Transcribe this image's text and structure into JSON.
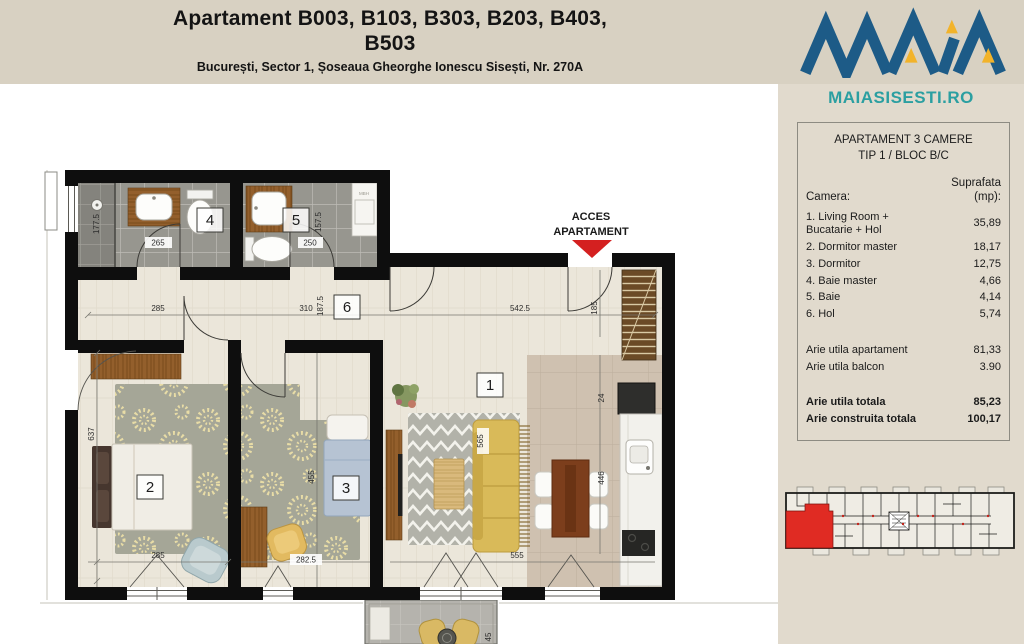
{
  "header": {
    "title_line1": "Apartament B003, B103, B303, B203, B403,",
    "title_line2": "B503",
    "subtitle": "București, Sector 1, Șoseaua Gheorghe Ionescu Sisești, Nr. 270A"
  },
  "logo": {
    "brand": "MAIA",
    "site": "MAIASISESTI.RO"
  },
  "panel": {
    "title_line1": "APARTAMENT 3 CAMERE",
    "title_line2": "TIP 1 / BLOC B/C",
    "col_room": "Camera:",
    "col_area_line1": "Suprafata",
    "col_area_line2": "(mp):",
    "rows": [
      {
        "label": "1. Living Room + Bucatarie + Hol",
        "value": "35,89"
      },
      {
        "label": "2. Dormitor master",
        "value": "18,17"
      },
      {
        "label": "3. Dormitor",
        "value": "12,75"
      },
      {
        "label": "4. Baie master",
        "value": "4,66"
      },
      {
        "label": "5. Baie",
        "value": "4,14"
      },
      {
        "label": "6. Hol",
        "value": "5,74"
      }
    ],
    "summary": [
      {
        "label": "Arie utila apartament",
        "value": "81,33"
      },
      {
        "label": "Arie utila balcon",
        "value": "3.90"
      }
    ],
    "totals": [
      {
        "label": "Arie utila totala",
        "value": "85,23"
      },
      {
        "label": "Arie construita totala",
        "value": "100,17"
      }
    ]
  },
  "floorplan": {
    "access_line1": "ACCES",
    "access_line2": "APARTAMENT",
    "rooms": [
      "1",
      "2",
      "3",
      "4",
      "5",
      "6"
    ],
    "washer_label": "MBH",
    "dims": {
      "bath4_w": "265",
      "bath4_h": "177.5",
      "bath5_w": "250",
      "bath5_h": "157.5",
      "hall_w1": "285",
      "hall_w2": "310",
      "hall_h": "187.5",
      "living_w": "542.5",
      "entry_w": "185",
      "bed2_h": "637",
      "bed2_w": "285",
      "bed3_w": "282.5",
      "bed3_h": "455",
      "living_bottom": "555",
      "sofa_len": "565",
      "kitchen_top": "24",
      "kitchen_run": "446",
      "balcony_d": "45"
    }
  },
  "colors": {
    "band": "#d8d1c2",
    "sidebar": "#e1dacd",
    "logo_blue": "#1d5b87",
    "logo_gold": "#f2b32a",
    "site_teal": "#2b9fa1",
    "accent_red": "#d42020",
    "mini_red": "#e02b23",
    "wall": "#0e0e0e"
  }
}
